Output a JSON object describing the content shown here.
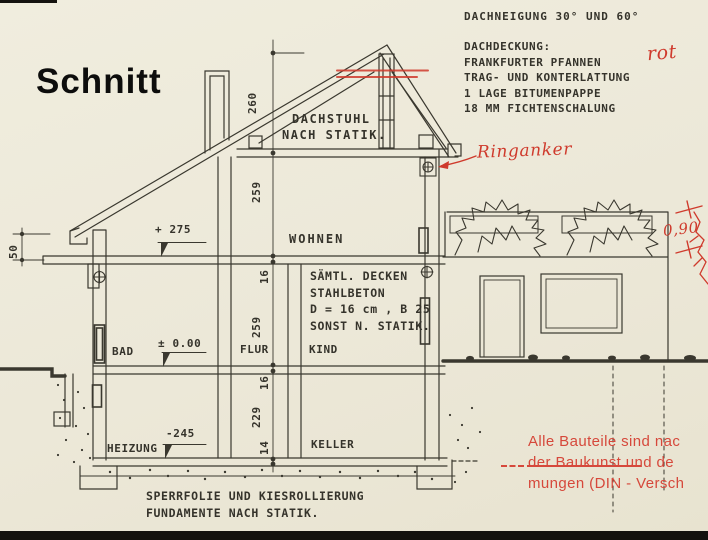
{
  "meta": {
    "title": "Schnitt"
  },
  "roof_notes": {
    "pitch": "DACHNEIGUNG 30° UND 60°",
    "covering": [
      "DACHDECKUNG:",
      "FRANKFURTER PFANNEN",
      "TRAG- UND KONTERLATTUNG",
      "1 LAGE BITUMENPAPPE",
      "18 MM FICHTENSCHALUNG"
    ]
  },
  "attic_note": [
    "DACHSTUHL",
    "NACH STATIK."
  ],
  "ceiling_note": [
    "SÄMTL. DECKEN",
    "STAHLBETON",
    "D = 16 cm , B 25",
    "SONST N. STATIK."
  ],
  "foundation_note": [
    "SPERRFOLIE UND KIESROLLIERUNG",
    "FUNDAMENTE NACH STATIK."
  ],
  "rooms": {
    "wohnen": "WOHNEN",
    "bad": "BAD",
    "flur": "FLUR",
    "kind": "KIND",
    "heizung": "HEIZUNG",
    "keller": "KELLER"
  },
  "levels": {
    "upper_floor": "+ 275",
    "ground_floor": "± 0.00",
    "basement": "-245"
  },
  "dimensions": {
    "roof_height": "260",
    "upper_room": "259",
    "upper_slab": "16",
    "ground_room": "259",
    "ground_slab": "16",
    "basement_room": "229",
    "basement_slab": "14",
    "eave_height": "50"
  },
  "red_annotations": {
    "roof_color": "rot",
    "ring_beam": "Ringanker",
    "parapet_dim": "0,90",
    "stamp": [
      "Alle Bauteile sind nac",
      "der Baukunst und de",
      "mungen (DIN - Versch"
    ]
  },
  "colors": {
    "paper": "#ece8d8",
    "ink": "#3a382f",
    "red": "#cf3a2c"
  }
}
